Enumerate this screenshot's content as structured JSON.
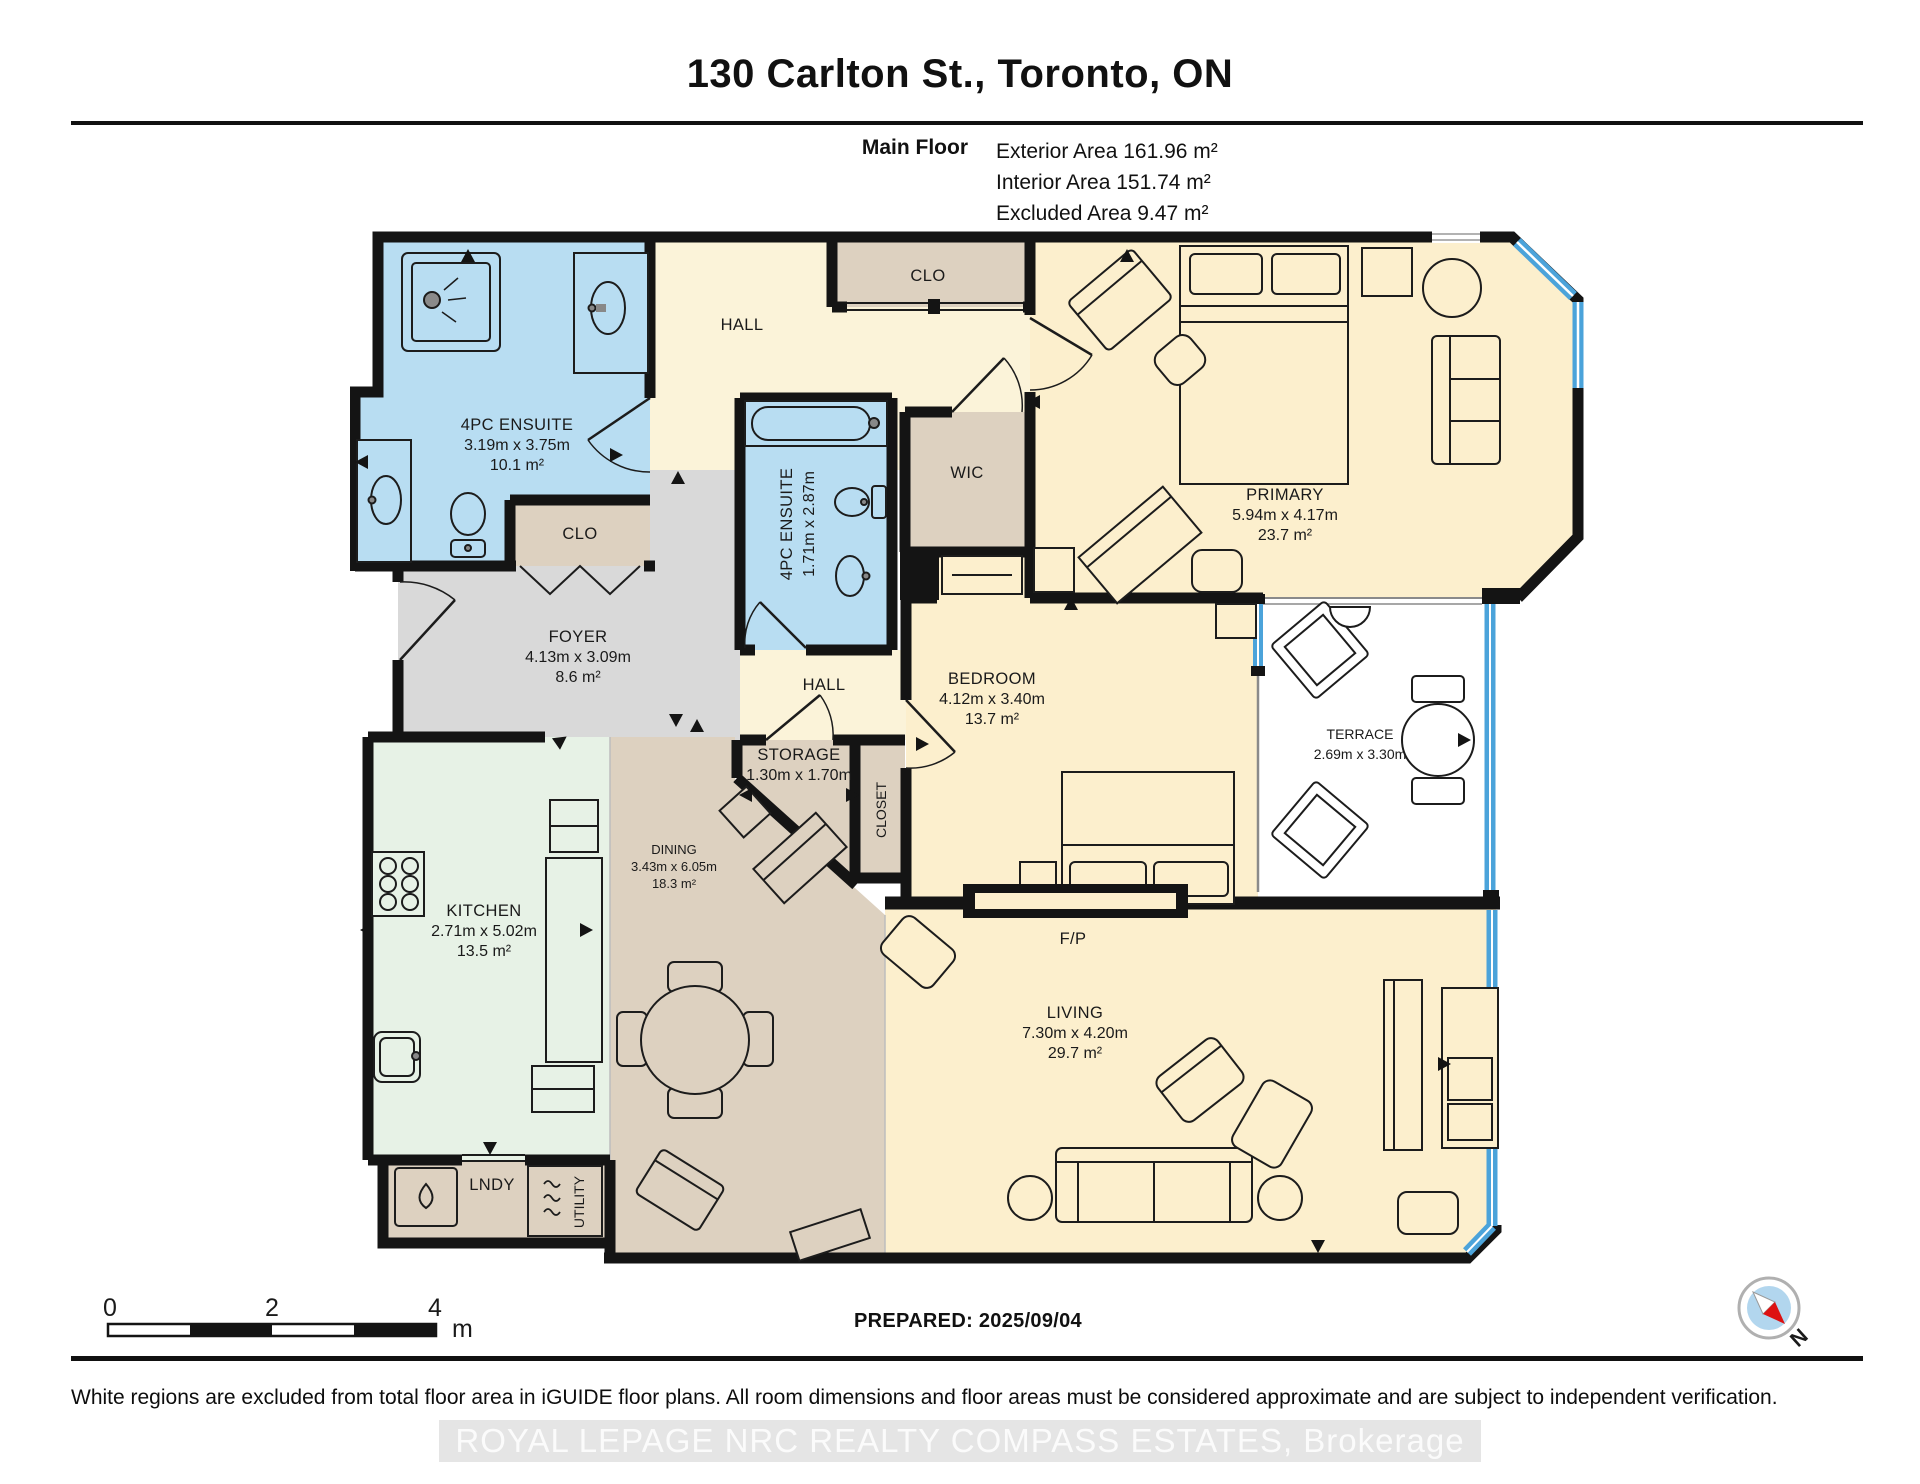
{
  "header": {
    "title": "130 Carlton St., Toronto, ON",
    "floor_label": "Main Floor",
    "exterior_area": "Exterior Area 161.96 m²",
    "interior_area": "Interior Area 151.74 m²",
    "excluded_area": "Excluded Area 9.47 m²"
  },
  "rooms": {
    "ensuite1": {
      "name": "4PC ENSUITE",
      "dims": "3.19m x 3.75m",
      "area": "10.1 m²"
    },
    "ensuite2": {
      "name": "4PC ENSUITE",
      "dims": "1.71m x 2.87m"
    },
    "hall1": {
      "name": "HALL"
    },
    "hall2": {
      "name": "HALL"
    },
    "clo_top": {
      "name": "CLO"
    },
    "clo_foyer": {
      "name": "CLO"
    },
    "wic": {
      "name": "WIC"
    },
    "primary": {
      "name": "PRIMARY",
      "dims": "5.94m x 4.17m",
      "area": "23.7 m²"
    },
    "foyer": {
      "name": "FOYER",
      "dims": "4.13m x 3.09m",
      "area": "8.6 m²"
    },
    "storage": {
      "name": "STORAGE",
      "dims": "1.30m x 1.70m"
    },
    "closet": {
      "name": "CLOSET"
    },
    "bedroom": {
      "name": "BEDROOM",
      "dims": "4.12m x 3.40m",
      "area": "13.7 m²"
    },
    "terrace": {
      "name": "TERRACE",
      "dims": "2.69m x 3.30m"
    },
    "kitchen": {
      "name": "KITCHEN",
      "dims": "2.71m x 5.02m",
      "area": "13.5 m²"
    },
    "dining": {
      "name": "DINING",
      "dims": "3.43m x 6.05m",
      "area": "18.3 m²"
    },
    "living": {
      "name": "LIVING",
      "dims": "7.30m x 4.20m",
      "area": "29.7 m²"
    },
    "lndy": {
      "name": "LNDY"
    },
    "utility": {
      "name": "UTILITY"
    },
    "fireplace": {
      "name": "F/P"
    }
  },
  "scale_bar": {
    "tick_0": "0",
    "tick_2": "2",
    "tick_4": "4",
    "unit": "m"
  },
  "prepared_label": "PREPARED: 2025/09/04",
  "compass": {
    "north_label": "N"
  },
  "footer": {
    "disclaimer": "White regions are excluded from total floor area in iGUIDE floor plans. All room dimensions and floor areas must be considered approximate and are subject to independent verification.",
    "watermark": "ROYAL LEPAGE NRC REALTY COMPASS ESTATES, Brokerage"
  },
  "colors": {
    "wall": "#141414",
    "bathroom_blue": "#b8ddf2",
    "hall_cream": "#fbf3d9",
    "bedroom_yellow": "#fcefcd",
    "closet_tan": "#ddd1c0",
    "kitchen_mint": "#e7f2e6",
    "foyer_gray": "#d9d9d9",
    "glazing_blue": "#4ba3da",
    "compass_north_red": "#dd1111"
  }
}
